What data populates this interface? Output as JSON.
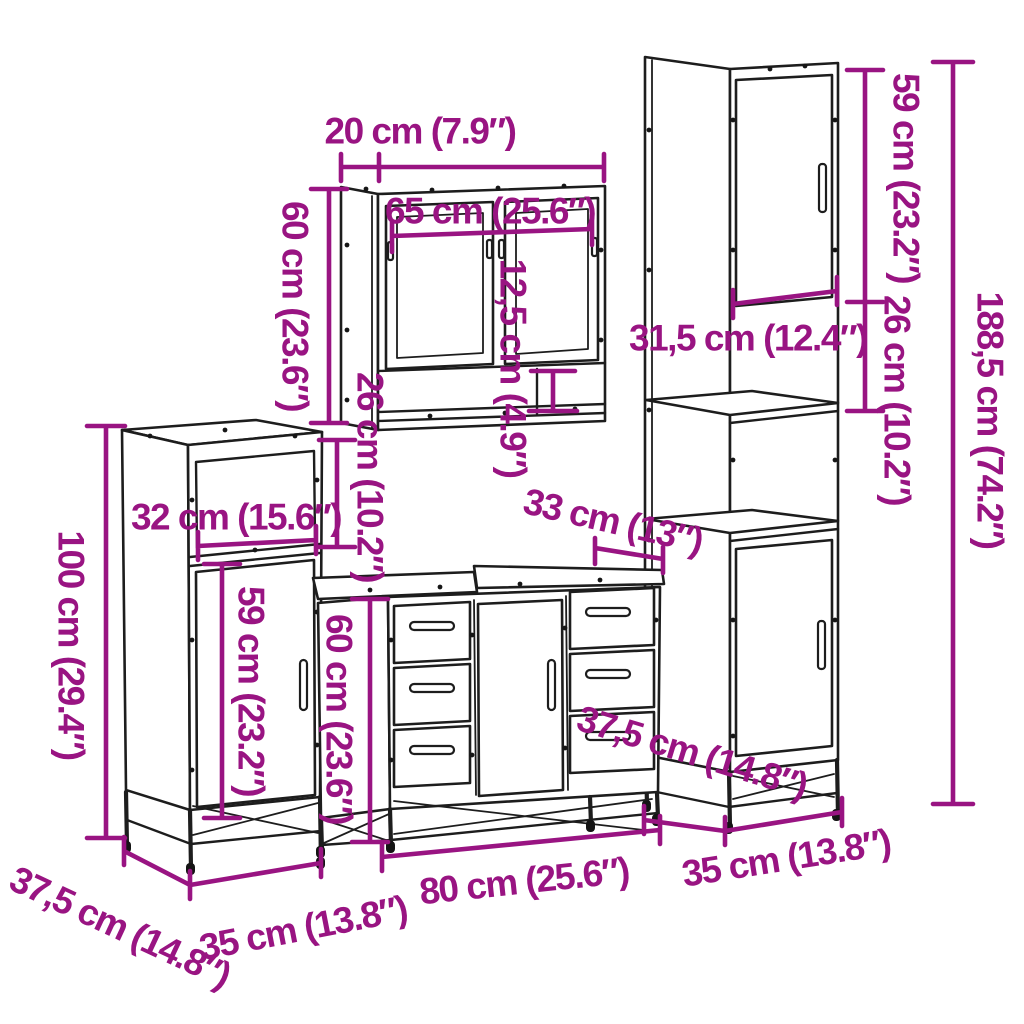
{
  "diagram": {
    "accent_color": "#991482",
    "line_color": "#1d1d1d",
    "background_color": "#ffffff",
    "dimensions": {
      "mirror_cabinet": {
        "depth": "20 cm (7.9″)",
        "width": "65 cm (25.6″)",
        "height": "60 cm (23.6″)",
        "shelf_height": "12,5 cm (4.9″)"
      },
      "tall_cabinet": {
        "door_height": "59 cm (23.2″)",
        "shelf_height": "26 cm (10.2″)",
        "inner_width": "31,5 cm (12.4″)",
        "total_height": "188,5 cm (74.2″)",
        "width": "35 cm (13.8″)",
        "depth": "37,5 cm (14.8″)"
      },
      "side_cabinet": {
        "total_height": "100 cm (29.4″)",
        "inner_width": "32 cm (15.6″)",
        "compartment_height": "26 cm (10.2″)",
        "door_height": "59 cm (23.2″)",
        "width": "35 cm (13.8″)",
        "depth": "37,5 cm (14.8″)"
      },
      "sink_cabinet": {
        "height": "60 cm (23.6″)",
        "width": "80 cm (25.6″)",
        "depth": "33 cm (13″)"
      }
    }
  }
}
